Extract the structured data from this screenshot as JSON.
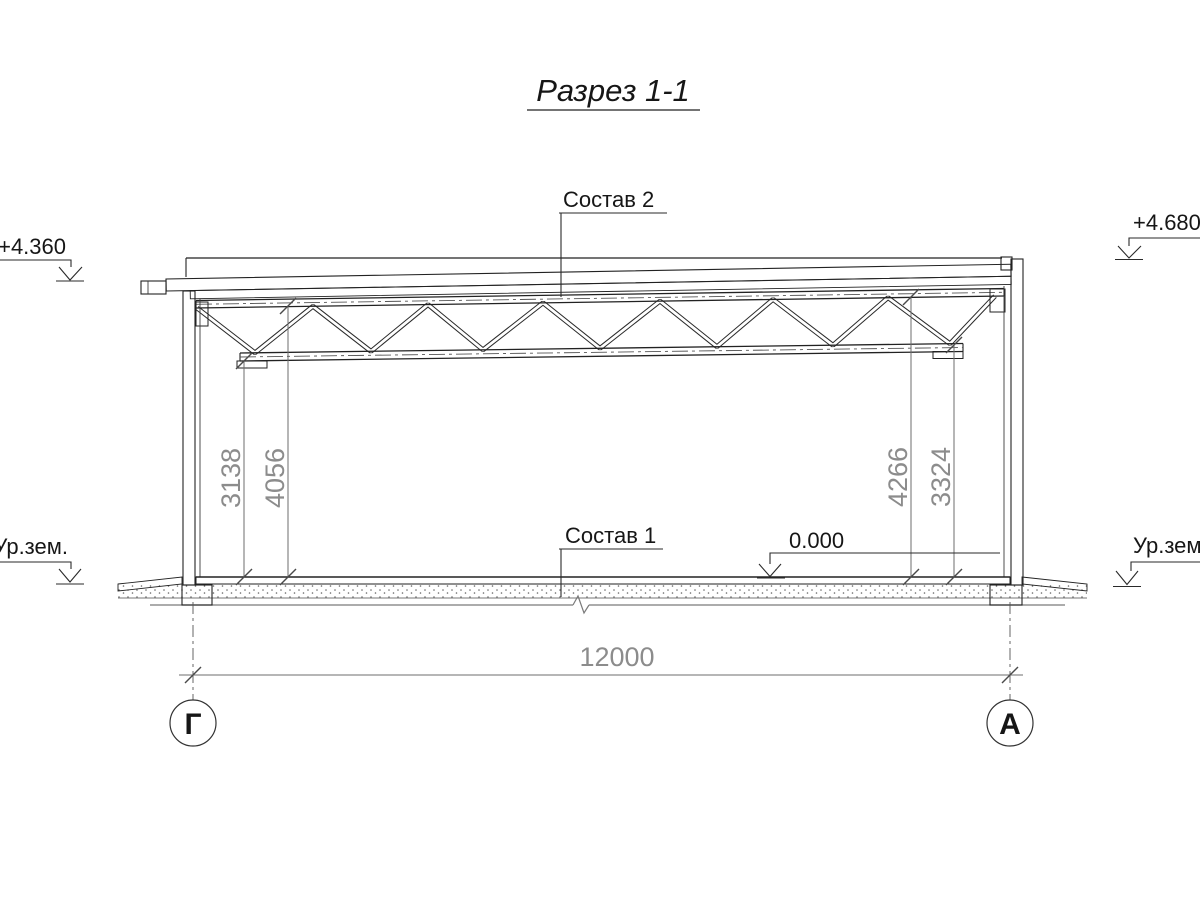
{
  "drawing": {
    "title": "Разрез 1-1",
    "callouts": {
      "roof_composition": "Состав 2",
      "floor_composition": "Состав 1"
    },
    "elevations": {
      "roof_left": "+4.360",
      "roof_right": "+4.680",
      "floor_zero": "0.000",
      "ground_left": "Ур.зем.",
      "ground_right": "Ур.зем."
    },
    "dimensions": {
      "left_to_bottom_chord": "3138",
      "left_to_roof": "4056",
      "right_to_roof": "4266",
      "right_to_bottom_chord": "3324",
      "span": "12000"
    },
    "axes": {
      "left_label": "Г",
      "right_label": "А"
    },
    "colors": {
      "ink": "#222222",
      "dimension_gray": "#8c8c8c",
      "background": "#ffffff"
    }
  }
}
